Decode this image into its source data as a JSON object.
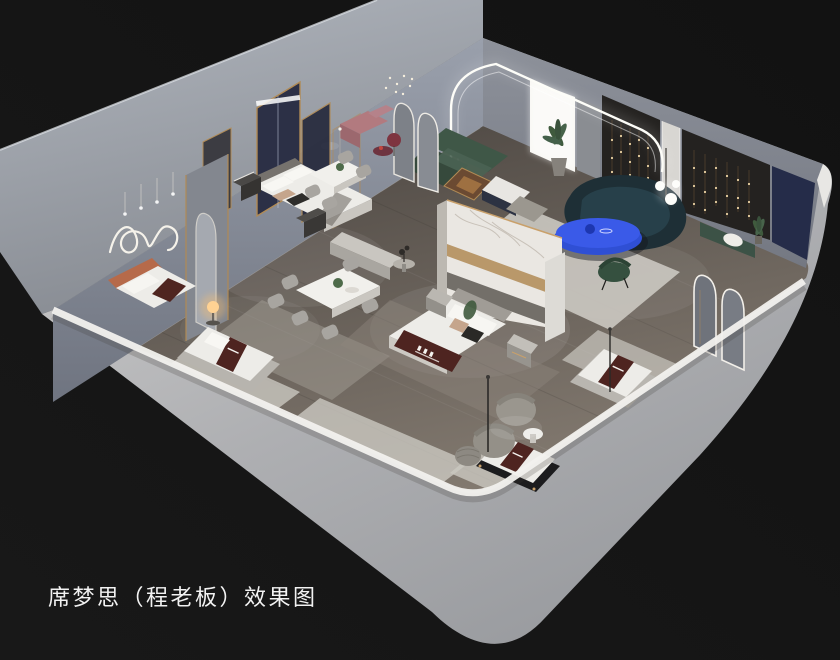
{
  "caption": {
    "text": "席梦思（程老板）效果图"
  },
  "scene": {
    "type": "3D isometric cutaway interior rendering",
    "subject": "Simmons mattress showroom on a grey plinth against a dark backdrop",
    "areas": [
      "bedroom displays along back wall",
      "two dining sets",
      "living lounge with LED cove arch",
      "mattress display gallery along front wall"
    ],
    "furniture": [
      "double bed with grey headboard and dark throw pillows",
      "double bed with terracotta headboard",
      "large bed with brown branded foot runner and marble partition headwall",
      "three low mattress displays with brown branded runners",
      "dining table with six grey chairs and plant centerpiece",
      "dining table with four grey chairs",
      "dark green corner sofa with timber display case",
      "dark teal curved sofa",
      "cobalt blue oval coffee table",
      "cobalt blue media console",
      "two grey boucle swivel chairs with round side table",
      "knitted pouf",
      "arched floor mirrors with lit trim",
      "gold framed navy fabric screens",
      "mauve bench with burgundy side table",
      "white orb floor lamp",
      "nightstands and wardrobe panel",
      "potted palms"
    ],
    "lighting": [
      "LED cove arch around lounge corner",
      "cascading string-light curtains on dark feature walls",
      "wavy neon wall art",
      "warm glowing orb table lamp",
      "pendant drop lights over beds",
      "backlit white wall panel"
    ]
  },
  "colors": {
    "bg": "#181818",
    "bgDeep": "#121212",
    "caption": "#f2f2f2",
    "plinthLight": "#b0b5bd",
    "plinthDark": "#878b92",
    "wallLight": "#d2d1d0",
    "wallMid": "#aeafb2",
    "wallShade": "#97999d",
    "wallBright": "#f2f1ee",
    "nwFaceTop": "#9aa0ac",
    "nwFaceBot": "#6e727c",
    "neFace": "#888c95",
    "floorDark": "#4e4843",
    "floorLight": "#847b71",
    "rug": "#cbc8c1",
    "rugDim": "#a9a49c",
    "marble": "#eae7e2",
    "gold": "#b08a55",
    "navyScreen": "#2c3046",
    "navyPanel": "#252c49",
    "darkPanel": "#242220",
    "sofaGreen": "#3f5747",
    "benchGreen": "#3c5246",
    "sofaTeal": "#1e2f36",
    "blue": "#2f4fd4",
    "blueLight": "#3a5ae8",
    "runnerBrown": "#4e2420",
    "mattress": "#edece8",
    "mauve": "#b27a7f",
    "wood": "#9a6a42",
    "lampWarm": "#ffc069",
    "led": "#fdfdf8",
    "stringLight": "#ecd3a3",
    "greyFurn": "#a8a5a0"
  }
}
